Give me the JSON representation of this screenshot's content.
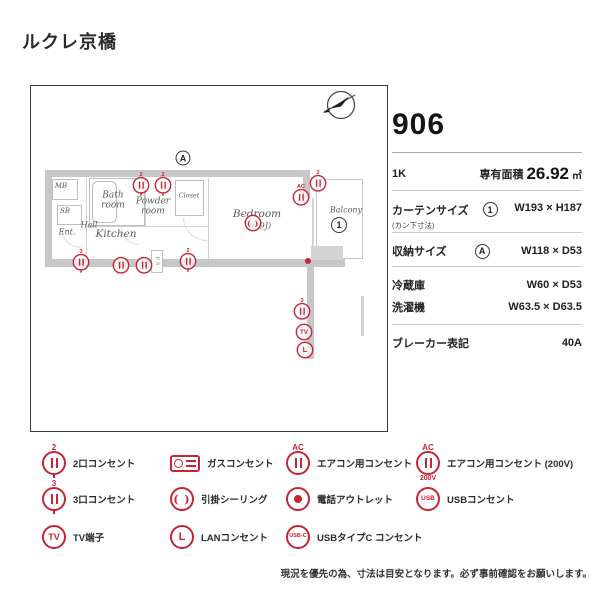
{
  "title": "ルクレ京橋",
  "markers": {
    "storage": "A",
    "curtain": "1"
  },
  "plan": {
    "rooms": {
      "mb": "MB",
      "sb": "SB",
      "ent": "Ent.",
      "hall": "Hall",
      "bath": "Bath room",
      "powder": "Powder room",
      "closet": "Closet",
      "kitchen": "Kitchen",
      "bedroom": "Bedroom",
      "bedroom_size": "(8.9J)",
      "balcony": "Balcony",
      "ps": "PS"
    }
  },
  "glyphs": {
    "two": "2",
    "three": "3",
    "ac": "AC",
    "v200": "200V",
    "tv": "TV",
    "lan": "L",
    "usb": "USB",
    "usbc": "USB-C",
    "paren": "( )"
  },
  "info": {
    "unit": "906",
    "layout": "1K",
    "area_label": "専有面積",
    "area_value": "26.92",
    "area_unit": "㎡",
    "curtain_label": "カーテンサイズ",
    "curtain_sub": "(カン下寸法)",
    "curtain_value": "W193 × H187",
    "storage_label": "収納サイズ",
    "storage_value": "W118 × D53",
    "fridge_label": "冷蔵庫",
    "fridge_value": "W60 × D53",
    "washer_label": "洗濯機",
    "washer_value": "W63.5 × D63.5",
    "breaker_label": "ブレーカー表記",
    "breaker_value": "40A"
  },
  "legend": {
    "outlet2": "2口コンセント",
    "outlet3": "3口コンセント",
    "tv": "TV端子",
    "gas": "ガスコンセント",
    "ceiling": "引掛シーリング",
    "lan": "LANコンセント",
    "ac": "エアコン用コンセント",
    "phone": "電話アウトレット",
    "usbc": "USBタイプC コンセント",
    "ac200": "エアコン用コンセント (200V)",
    "usb": "USBコンセント"
  },
  "disclaimer": "現況を優先の為、寸法は目安となります。必ず事前確認をお願いします。"
}
